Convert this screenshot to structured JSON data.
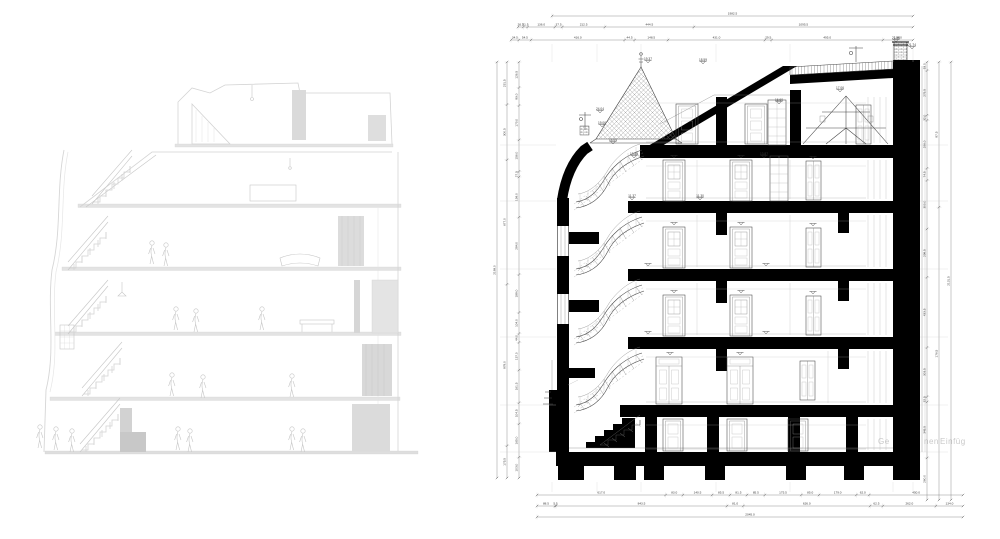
{
  "meta": {
    "background": "#ffffff",
    "colors": {
      "poche": "#000000",
      "line": "#444444",
      "dim_line": "#666666",
      "dim_text": "#3a3a3a",
      "ghost": "#d4d4d4",
      "watermark": "#c9c9c9"
    },
    "panels": {
      "left": "point-cloud scan section (faint)",
      "right": "CAD building cross-section"
    }
  },
  "left_drawing": {
    "type": "point-cloud-section",
    "floors": 6
  },
  "right_drawing": {
    "type": "cad-section",
    "watermark": {
      "part1": "Ge",
      "part2": "nen",
      "part3": "Einfüg"
    },
    "dims_top": {
      "row1": [
        "1982.5"
      ],
      "row2": [
        "26.5",
        "21.5",
        "136.0",
        "37.5",
        "212.5",
        "444.5",
        "1095.5"
      ],
      "row3": [
        "34.5",
        "54.5",
        "416.0",
        "44.5",
        "148.5",
        "431.0",
        "29.5",
        "495.0",
        "134.0"
      ]
    },
    "dims_bottom": {
      "row1": [
        "617.0",
        "83.0",
        "140.5",
        "85.5",
        "81.5",
        "85.5",
        "175.5",
        "85.0",
        "179.0",
        "62.0",
        "450.0"
      ],
      "row2": [
        "88.5",
        "5.5",
        "843.5",
        "81.0",
        "626.0",
        "62.5",
        "262.0",
        "134.0"
      ],
      "row3": [
        "2045.0"
      ]
    },
    "dims_left": {
      "col_outer": [
        "2189.0"
      ],
      "col_mid": [
        "231.5",
        "300.5",
        "677.0",
        "878.0",
        "175.5"
      ],
      "col_inner": [
        "126.5",
        "89.0",
        "170.0",
        "156.0",
        "27.5",
        "199.0",
        "284.0",
        "188.0",
        "104.0",
        "44.0",
        "137.0",
        "161.5",
        "104.5",
        "165.0",
        "103.0"
      ]
    },
    "dims_right": {
      "col_inner": [
        "53.0",
        "275.5",
        "32.0",
        "296.0",
        "74.5",
        "300.0",
        "298.5",
        "433.5",
        "303.5",
        "32.5",
        "345.5",
        "260.0"
      ],
      "col_mid": [
        "87.5",
        "176.5"
      ],
      "col_outer": [
        "2131.5"
      ]
    },
    "elevation_labels": [
      {
        "v": "19.37",
        "x": 648,
        "y": 61
      },
      {
        "v": "24.04",
        "x": 600,
        "y": 111
      },
      {
        "v": "19.06",
        "x": 602,
        "y": 125
      },
      {
        "v": "14.04",
        "x": 613,
        "y": 142
      },
      {
        "v": "13.88",
        "x": 634,
        "y": 156
      },
      {
        "v": "13.87",
        "x": 764,
        "y": 156
      },
      {
        "v": "17.06",
        "x": 840,
        "y": 90
      },
      {
        "v": "16.60",
        "x": 779,
        "y": 102
      },
      {
        "v": "18.59",
        "x": 703,
        "y": 62
      },
      {
        "v": "21.48",
        "x": 896,
        "y": 40
      },
      {
        "v": "21.74",
        "x": 912,
        "y": 47
      },
      {
        "v": "11.37",
        "x": 632,
        "y": 198
      },
      {
        "v": "11.30",
        "x": 700,
        "y": 198
      }
    ]
  }
}
